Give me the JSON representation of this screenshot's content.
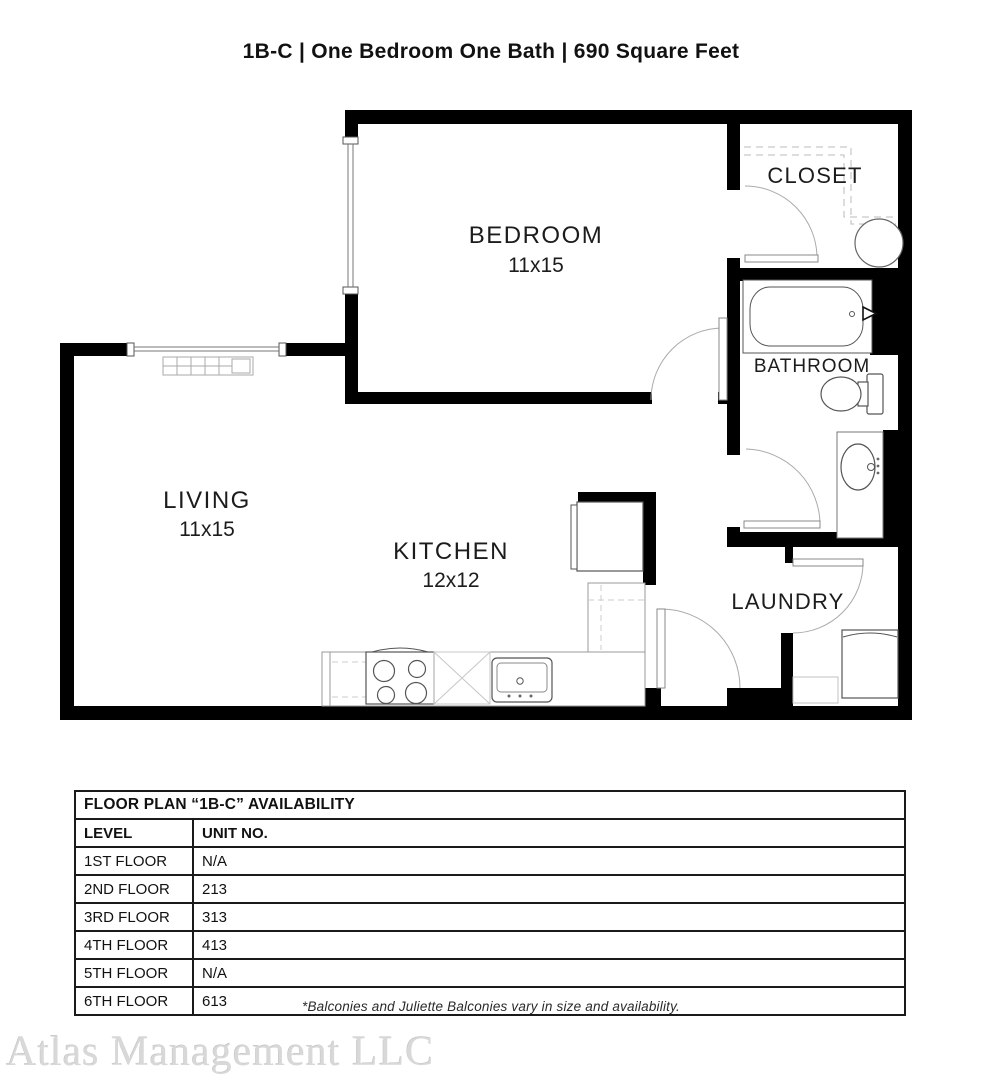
{
  "title": "1B-C  | One Bedroom One Bath |  690 Square Feet",
  "rooms": {
    "bedroom": {
      "name": "BEDROOM",
      "dims": "11x15"
    },
    "living": {
      "name": "LIVING",
      "dims": "11x15"
    },
    "kitchen": {
      "name": "KITCHEN",
      "dims": "12x12"
    },
    "closet": {
      "name": "CLOSET"
    },
    "bathroom": {
      "name": "BATHROOM"
    },
    "laundry": {
      "name": "LAUNDRY"
    }
  },
  "availability_table": {
    "title": "FLOOR PLAN “1B-C” AVAILABILITY",
    "columns": [
      "LEVEL",
      "UNIT NO."
    ],
    "rows": [
      [
        "1ST FLOOR",
        "N/A"
      ],
      [
        "2ND FLOOR",
        "213"
      ],
      [
        "3RD FLOOR",
        "313"
      ],
      [
        "4TH FLOOR",
        "413"
      ],
      [
        "5TH FLOOR",
        "N/A"
      ],
      [
        "6TH FLOOR",
        "613"
      ]
    ]
  },
  "footnote": "*Balconies and Juliette Balconies vary in size and availability.",
  "watermark": "Atlas Management LLC",
  "colors": {
    "wall": "#000000",
    "fixture_line": "#555555",
    "light_line": "#9a9a9a",
    "text": "#1a1a1a",
    "watermark": "#d8d8d8"
  }
}
